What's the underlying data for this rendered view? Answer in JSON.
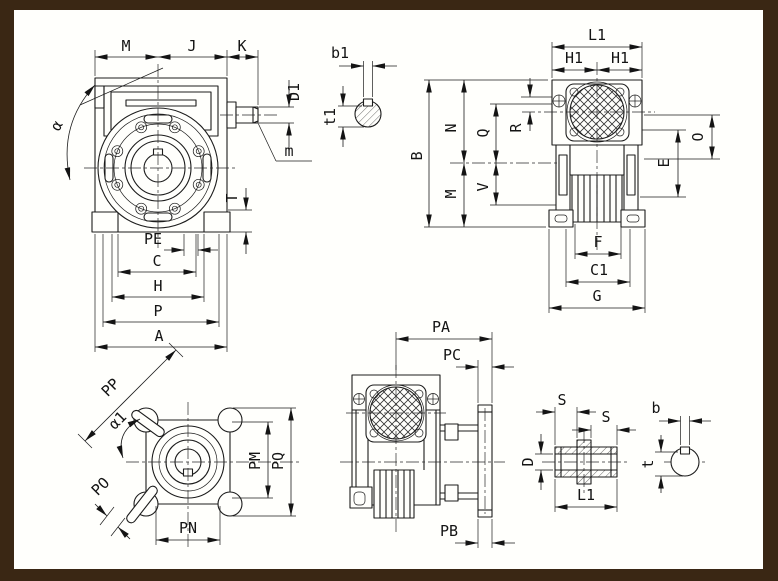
{
  "colors": {
    "background": "#3a2714",
    "paper": "#fffffc",
    "line": "#1c1c1c"
  },
  "views": {
    "front": {
      "dim_m": "M",
      "dim_j": "J",
      "dim_k": "K",
      "dim_d1": "D1",
      "dim_mod": "m",
      "dim_alpha": "α",
      "dim_t": "T",
      "dim_pe": "PE",
      "dim_c": "C",
      "dim_h": "H",
      "dim_p": "P",
      "dim_a": "A"
    },
    "input_key": {
      "dim_b1": "b1",
      "dim_t1": "t1"
    },
    "side": {
      "dim_l1": "L1",
      "dim_h1_left": "H1",
      "dim_h1_right": "H1",
      "dim_b": "B",
      "dim_n": "N",
      "dim_m": "M",
      "dim_q": "Q",
      "dim_v": "V",
      "dim_r": "R",
      "dim_e": "E",
      "dim_o": "O",
      "dim_f": "F",
      "dim_c1": "C1",
      "dim_g": "G"
    },
    "output_flange": {
      "dim_pp": "PP",
      "dim_alpha1": "α1",
      "dim_po": "PO",
      "dim_pm": "PM",
      "dim_pq": "PQ",
      "dim_pn": "PN"
    },
    "side_output": {
      "dim_pa": "PA",
      "dim_pc": "PC",
      "dim_pb": "PB"
    },
    "hollow_shaft": {
      "dim_s_left": "S",
      "dim_s_right": "S",
      "dim_d": "D",
      "dim_l1": "L1"
    },
    "output_key": {
      "dim_b": "b",
      "dim_t": "t"
    }
  }
}
